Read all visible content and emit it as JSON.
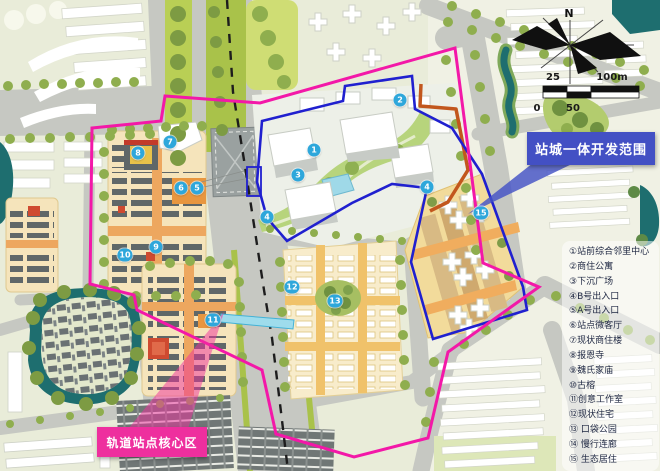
{
  "map": {
    "callouts": {
      "blue_label": "站城一体开发范围",
      "magenta_label": "轨道站点核心区"
    },
    "compass": {
      "north_label": "N"
    },
    "scale_bar": {
      "top_left": "25",
      "top_right": "100m",
      "bottom_left": "0",
      "bottom_mid": "50"
    },
    "markers": [
      {
        "label": "1"
      },
      {
        "label": "2"
      },
      {
        "label": "3"
      },
      {
        "label": "4"
      },
      {
        "label": "4"
      },
      {
        "label": "5"
      },
      {
        "label": "6"
      },
      {
        "label": "7"
      },
      {
        "label": "8"
      },
      {
        "label": "9"
      },
      {
        "label": "10"
      },
      {
        "label": "11"
      },
      {
        "label": "12"
      },
      {
        "label": "13"
      },
      {
        "label": "15"
      }
    ],
    "colors": {
      "magenta_boundary": "#f318a8",
      "blue_boundary": "#2020cf",
      "blue_box": "#4350c4",
      "magenta_box": "#ee2f9e",
      "marker_blue": "#2ea7db",
      "orange_line": "#c2571d",
      "rail_dash": "#1d1d1d",
      "water": "#1e6e6f",
      "road": "#c6c8c2"
    }
  },
  "legend": {
    "items": [
      "①站前综合邻里中心",
      "②商住公寓",
      "③下沉广场",
      "④B号出入口",
      "⑤A号出入口",
      "⑥站点微客厅",
      "⑦现状商住楼",
      "⑧报恩寺",
      "⑨魏氏家庙",
      "⑩古榕",
      "⑪创意工作室",
      "⑫现状住宅",
      "⑬ 口袋公园",
      "⑭ 慢行连廊",
      "⑮ 生态居住"
    ]
  }
}
